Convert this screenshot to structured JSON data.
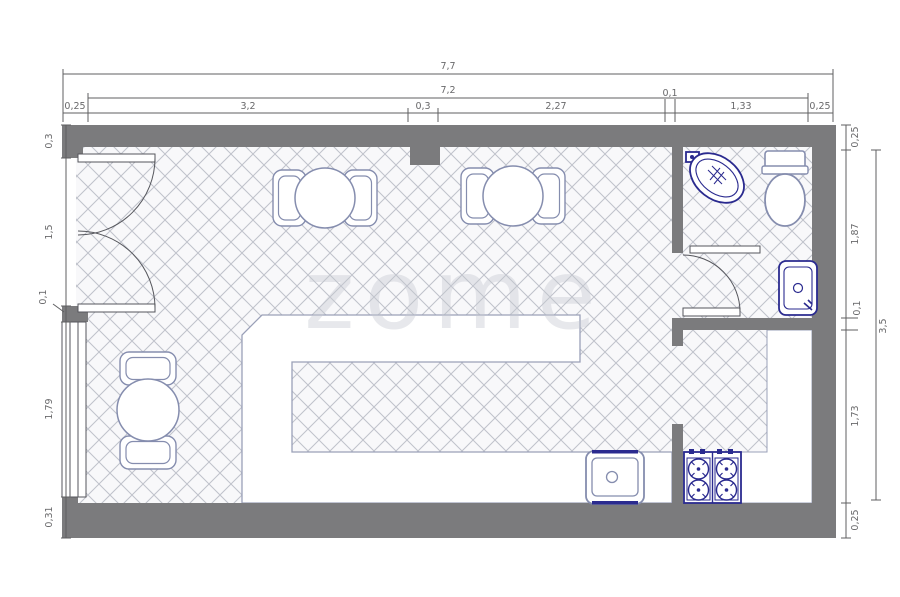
{
  "drawing": {
    "type": "floor-plan",
    "watermark": "zome"
  },
  "colors": {
    "wall": "#7b7b7d",
    "floor_fill": "#f8f8fa",
    "hatch_line": "#bfc2cb",
    "counter_outline": "#9aa0b8",
    "fixture_navy": "#2a2a8f",
    "fixture_blue": "#858dae",
    "door_line": "#55565c",
    "dim_line": "#5f5f61",
    "dim_text": "#69696b",
    "watermark": "#c5c8d0"
  },
  "dimensions": {
    "top": {
      "total": "7,7",
      "inner": "7,2",
      "segments": [
        "0,25",
        "3,2",
        "0,3",
        "2,27",
        "0,1",
        "1,33",
        "0,25"
      ]
    },
    "left": {
      "segments": [
        "0,3",
        "1,5",
        "0,1",
        "1,79",
        "0,31"
      ]
    },
    "right": {
      "segments": [
        "0,25",
        "1,87",
        "0,1",
        "1,73",
        "0,25"
      ],
      "total": "3,5"
    }
  },
  "fixtures": {
    "labels": [
      "entrance-double-door",
      "window",
      "round-table-with-chairs",
      "bar-counter",
      "kitchen-sink",
      "gas-stove",
      "interior-door",
      "corner-washbasin",
      "toilet",
      "washbasin"
    ]
  }
}
